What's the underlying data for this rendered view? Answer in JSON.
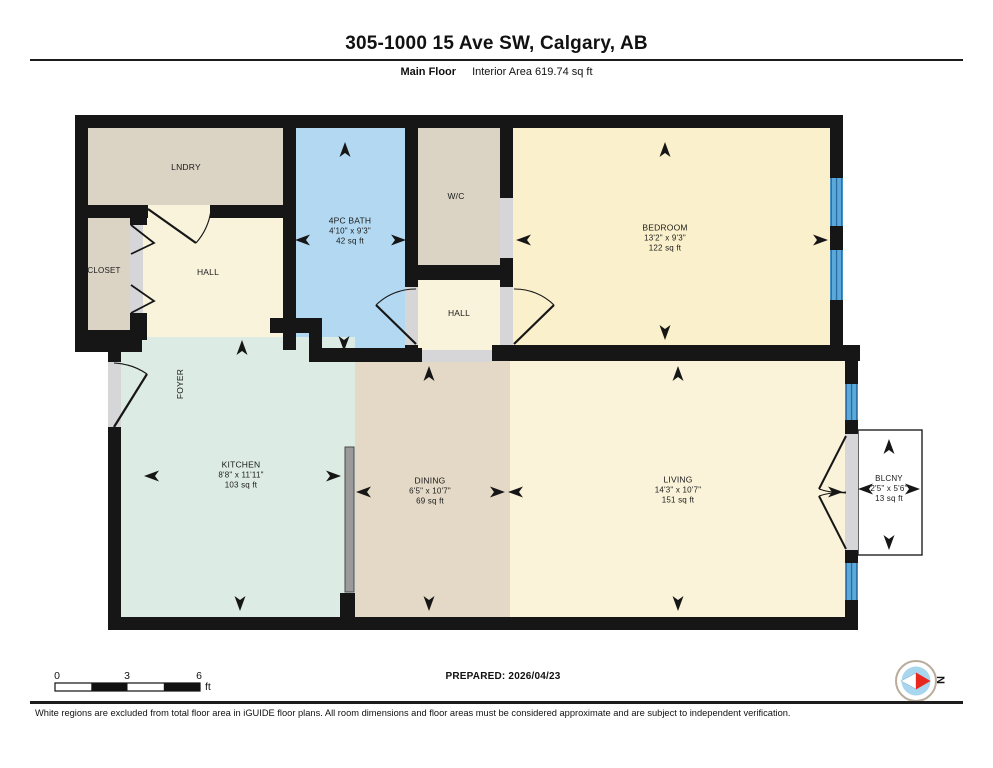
{
  "header": {
    "title": "305-1000 15 Ave SW, Calgary, AB",
    "floor_label": "Main Floor",
    "area_label": "Interior Area 619.74 sq ft"
  },
  "rooms": {
    "lndry": {
      "name": "LNDRY"
    },
    "closet": {
      "name": "CLOSET"
    },
    "hall_upper": {
      "name": "HALL"
    },
    "bath": {
      "name": "4PC BATH",
      "dim": "4'10\" x 9'3\"",
      "area": "42 sq ft"
    },
    "wc": {
      "name": "W/C"
    },
    "hall_center": {
      "name": "HALL"
    },
    "bedroom": {
      "name": "BEDROOM",
      "dim": "13'2\" x 9'3\"",
      "area": "122 sq ft"
    },
    "foyer": {
      "name": "FOYER"
    },
    "kitchen": {
      "name": "KITCHEN",
      "dim": "8'8\" x 11'11\"",
      "area": "103 sq ft"
    },
    "dining": {
      "name": "DINING",
      "dim": "6'5\" x 10'7\"",
      "area": "69 sq ft"
    },
    "living": {
      "name": "LIVING",
      "dim": "14'3\" x 10'7\"",
      "area": "151 sq ft"
    },
    "blcny": {
      "name": "BLCNY",
      "dim": "2'5\" x 5'6\"",
      "area": "13 sq ft"
    }
  },
  "scale_bar": {
    "labels": [
      "0",
      "3",
      "6"
    ],
    "unit": "ft"
  },
  "prepared_label": "PREPARED: 2026/04/23",
  "compass": {
    "label": "N"
  },
  "footer": {
    "disclaimer": "White regions are excluded from total floor area in iGUIDE floor plans. All room dimensions and floor areas must be considered approximate and are subject to independent verification."
  },
  "colors": {
    "wall": "#161616",
    "bath_floor": "#b3d9f2",
    "beige_floor": "#dbd3c4",
    "cream_floor": "#faf3dc",
    "bedroom_floor": "#faf0cb",
    "kitchen_floor": "#dcebe3",
    "dining_floor": "#e3d9c6",
    "living_floor": "#faf3da",
    "window": "#5ba8da",
    "window_stripe": "#2a6da3",
    "opening": "#d6d5d8",
    "counter": "#9a9a9a",
    "compass_red": "#e8271f",
    "compass_blue": "#a9d6ef"
  }
}
